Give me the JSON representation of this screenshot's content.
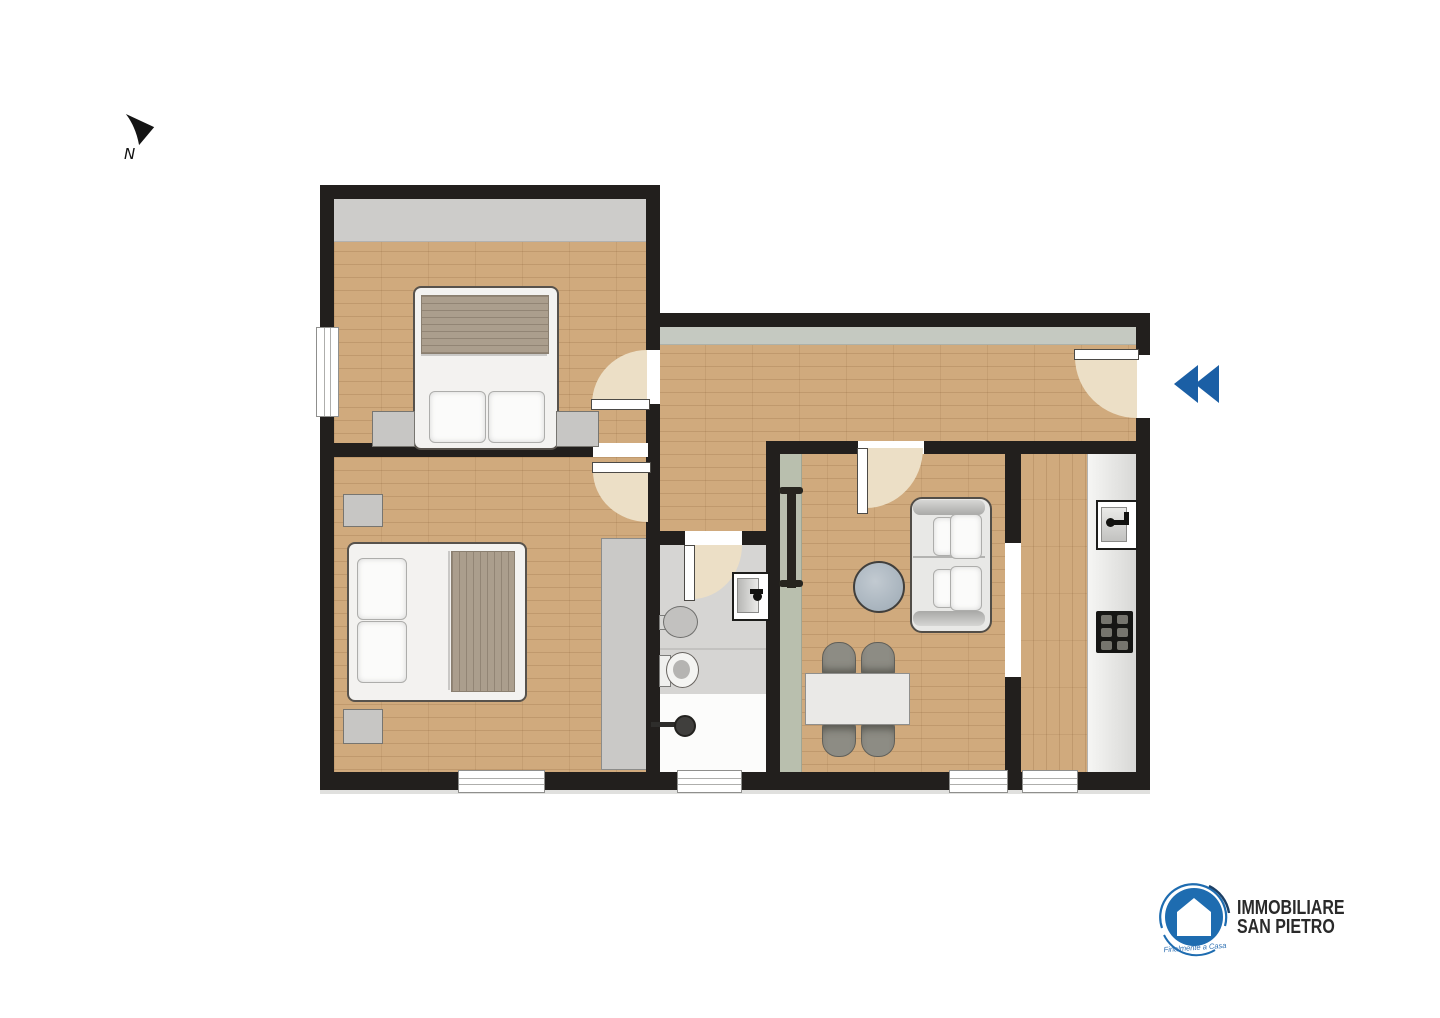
{
  "canvas": {
    "width": 1440,
    "height": 1018,
    "background": "#ffffff"
  },
  "compass": {
    "label": "N"
  },
  "entrance": {
    "color": "#1b5fa5"
  },
  "logo": {
    "line1": "IMMOBILIARE",
    "line2": "SAN PIETRO",
    "tagline": "Finalmente a Casa",
    "circle_color": "#1e6cb0",
    "swirl_dark": "#1c4066",
    "text_color": "#2a2a2a"
  },
  "palette": {
    "wall": "#221f1d",
    "wood": "#d0aa7d",
    "wood_line": "rgba(125,85,45,0.20)",
    "wood_seam": "rgba(120,80,40,0.12)",
    "tile": "#d6d5d3",
    "door_arc": "#ecdfc6",
    "blanket": "#ab9e8d",
    "band_gray": "#cdccca",
    "band_green": "#c5c9c1",
    "sage": "#b9bfae"
  },
  "plan": {
    "shapes": [
      {
        "n": "bedroom1-floor",
        "t": "wood-h",
        "x": 334,
        "y": 199,
        "w": 312,
        "h": 244
      },
      {
        "n": "bedroom1-closet-band",
        "t": "rect",
        "x": 334,
        "y": 199,
        "w": 312,
        "h": 42,
        "f": "#cdccca",
        "bb": "1px solid #b2b1af"
      },
      {
        "n": "bedroom2-floor",
        "t": "wood-h",
        "x": 334,
        "y": 457,
        "w": 312,
        "h": 319
      },
      {
        "n": "hallway-floor",
        "t": "wood-h",
        "x": 658,
        "y": 327,
        "w": 478,
        "h": 116
      },
      {
        "n": "hallway-band",
        "t": "rect",
        "x": 658,
        "y": 327,
        "w": 478,
        "h": 17,
        "f": "#c5c9c1",
        "bb": "1px solid #adb1a9"
      },
      {
        "n": "hallway-extension-floor",
        "t": "wood-h",
        "x": 658,
        "y": 441,
        "w": 108,
        "h": 92
      },
      {
        "n": "living-floor",
        "t": "wood-h",
        "x": 780,
        "y": 452,
        "w": 227,
        "h": 324
      },
      {
        "n": "living-sage-strip",
        "t": "rect",
        "x": 780,
        "y": 452,
        "w": 21,
        "h": 324,
        "f": "#b9bfae",
        "brr": "1px solid #a0a593"
      },
      {
        "n": "kitchen-floor",
        "t": "wood-v",
        "x": 1020,
        "y": 452,
        "w": 116,
        "h": 324
      },
      {
        "n": "kitchen-counter",
        "t": "rect",
        "x": 1087,
        "y": 452,
        "w": 49,
        "h": 324,
        "f": "linear-gradient(90deg,#f6f6f4,#d7d7d5)",
        "bll": "1px solid #b3b3b1"
      },
      {
        "n": "bathroom-floor",
        "t": "rect",
        "x": 660,
        "y": 545,
        "w": 106,
        "h": 231,
        "f": "#d6d5d3"
      },
      {
        "n": "bathroom-zone-divider",
        "t": "rect",
        "x": 660,
        "y": 648,
        "w": 106,
        "h": 2,
        "f": "#c3c2c0"
      },
      {
        "n": "shower-floor",
        "t": "rect",
        "x": 660,
        "y": 694,
        "w": 106,
        "h": 82,
        "f": "#fcfcfb"
      },
      {
        "n": "bedroom2-wardrobe",
        "t": "rect",
        "x": 601,
        "y": 538,
        "w": 45,
        "h": 230,
        "f": "#cac9c7",
        "bd": "1px solid #8c8c8a"
      },
      {
        "n": "wall-bedroom1-top",
        "t": "wall",
        "x": 320,
        "y": 185,
        "w": 340,
        "h": 14
      },
      {
        "n": "wall-left",
        "t": "wall",
        "x": 320,
        "y": 185,
        "w": 14,
        "h": 605
      },
      {
        "n": "wall-bottom",
        "t": "wall",
        "x": 320,
        "y": 772,
        "w": 830,
        "h": 18
      },
      {
        "n": "plan-bottom-shadow",
        "t": "rect",
        "x": 320,
        "y": 790,
        "w": 830,
        "h": 4,
        "f": "#e0e0de"
      },
      {
        "n": "wall-bedroom1-right",
        "t": "wall",
        "x": 646,
        "y": 185,
        "w": 14,
        "h": 272
      },
      {
        "n": "wall-hallway-top",
        "t": "wall",
        "x": 646,
        "y": 313,
        "w": 504,
        "h": 14
      },
      {
        "n": "wall-bedrooms-divider",
        "t": "wall",
        "x": 320,
        "y": 443,
        "w": 340,
        "h": 14
      },
      {
        "n": "wall-bathroom-left",
        "t": "wall",
        "x": 646,
        "y": 457,
        "w": 14,
        "h": 319
      },
      {
        "n": "wall-right",
        "t": "wall",
        "x": 1136,
        "y": 313,
        "w": 14,
        "h": 477
      },
      {
        "n": "wall-living-kitchen-top",
        "t": "wall",
        "x": 766,
        "y": 441,
        "w": 370,
        "h": 13
      },
      {
        "n": "wall-living-left",
        "t": "wall",
        "x": 766,
        "y": 441,
        "w": 14,
        "h": 335
      },
      {
        "n": "wall-bathroom-top",
        "t": "wall",
        "x": 646,
        "y": 531,
        "w": 120,
        "h": 14
      },
      {
        "n": "wall-living-kitchen-divider",
        "t": "wall",
        "x": 1005,
        "y": 441,
        "w": 16,
        "h": 335
      },
      {
        "n": "bedroom1-door-opening",
        "t": "open",
        "x": 646,
        "y": 350,
        "w": 14,
        "h": 54
      },
      {
        "n": "bedroom2-door-opening",
        "t": "open",
        "x": 593,
        "y": 443,
        "w": 55,
        "h": 14
      },
      {
        "n": "bathroom-door-opening",
        "t": "open",
        "x": 685,
        "y": 531,
        "w": 57,
        "h": 14
      },
      {
        "n": "living-door-opening",
        "t": "open",
        "x": 858,
        "y": 441,
        "w": 66,
        "h": 13
      },
      {
        "n": "kitchen-passage-opening",
        "t": "open",
        "x": 1005,
        "y": 543,
        "w": 16,
        "h": 134
      },
      {
        "n": "entrance-opening",
        "t": "open",
        "x": 1136,
        "y": 355,
        "w": 14,
        "h": 63
      },
      {
        "n": "bedroom1-window",
        "t": "window-v",
        "x": 316,
        "y": 327,
        "w": 21,
        "h": 88
      },
      {
        "n": "bedroom2-window",
        "t": "window-h",
        "x": 458,
        "y": 770,
        "w": 85,
        "h": 21
      },
      {
        "n": "bathroom-window",
        "t": "window-h",
        "x": 677,
        "y": 770,
        "w": 63,
        "h": 21
      },
      {
        "n": "living-window",
        "t": "window-h",
        "x": 949,
        "y": 770,
        "w": 57,
        "h": 21
      },
      {
        "n": "kitchen-window",
        "t": "window-h",
        "x": 1022,
        "y": 770,
        "w": 54,
        "h": 21
      },
      {
        "n": "bedroom1-door-arc",
        "t": "arc",
        "x": 592,
        "y": 350,
        "w": 55,
        "h": 54,
        "c": "tl"
      },
      {
        "n": "bedroom1-door-leaf",
        "t": "leaf",
        "x": 591,
        "y": 399,
        "w": 57,
        "h": 9
      },
      {
        "n": "bedroom2-door-arc",
        "t": "arc",
        "x": 593,
        "y": 471,
        "w": 55,
        "h": 51,
        "c": "bl"
      },
      {
        "n": "bedroom2-door-leaf",
        "t": "leaf",
        "x": 592,
        "y": 462,
        "w": 57,
        "h": 9
      },
      {
        "n": "bathroom-door-arc",
        "t": "arc",
        "x": 692,
        "y": 545,
        "w": 50,
        "h": 54,
        "c": "br"
      },
      {
        "n": "bathroom-door-leaf",
        "t": "leaf",
        "x": 684,
        "y": 545,
        "w": 9,
        "h": 54
      },
      {
        "n": "living-door-arc",
        "t": "arc",
        "x": 866,
        "y": 448,
        "w": 57,
        "h": 60,
        "c": "br"
      },
      {
        "n": "living-door-leaf",
        "t": "leaf",
        "x": 857,
        "y": 448,
        "w": 9,
        "h": 64
      },
      {
        "n": "entrance-door-arc",
        "t": "arc",
        "x": 1075,
        "y": 357,
        "w": 62,
        "h": 61,
        "c": "bl"
      },
      {
        "n": "entrance-door-leaf",
        "t": "leaf",
        "x": 1074,
        "y": 349,
        "w": 63,
        "h": 9
      },
      {
        "n": "bed1-frame",
        "t": "rect",
        "x": 413,
        "y": 286,
        "w": 142,
        "h": 160,
        "f": "#f3f2f0",
        "bd": "2px solid #57524c",
        "r": "8px"
      },
      {
        "n": "bed1-blanket",
        "t": "blanket-h",
        "x": 421,
        "y": 295,
        "w": 126,
        "h": 57
      },
      {
        "n": "bed1-sheet-line",
        "t": "rect",
        "x": 421,
        "y": 354,
        "w": 126,
        "h": 2,
        "f": "#c9c8c6"
      },
      {
        "n": "bed1-pillow-left",
        "t": "pillow",
        "x": 429,
        "y": 391,
        "w": 55,
        "h": 50
      },
      {
        "n": "bed1-pillow-right",
        "t": "pillow",
        "x": 488,
        "y": 391,
        "w": 55,
        "h": 50
      },
      {
        "n": "bedroom1-nightstand-left",
        "t": "rect",
        "x": 372,
        "y": 411,
        "w": 41,
        "h": 34,
        "f": "#c7c6c4",
        "bd": "1px solid #777570"
      },
      {
        "n": "bedroom1-nightstand-right",
        "t": "rect",
        "x": 556,
        "y": 411,
        "w": 41,
        "h": 34,
        "f": "#c7c6c4",
        "bd": "1px solid #777570"
      },
      {
        "n": "bed2-frame",
        "t": "rect",
        "x": 347,
        "y": 542,
        "w": 176,
        "h": 156,
        "f": "#f3f2f0",
        "bd": "2px solid #57524c",
        "r": "8px"
      },
      {
        "n": "bed2-blanket",
        "t": "blanket-v",
        "x": 451,
        "y": 551,
        "w": 62,
        "h": 139
      },
      {
        "n": "bed2-sheet-line",
        "t": "rect",
        "x": 448,
        "y": 551,
        "w": 2,
        "h": 139,
        "f": "#c9c8c6"
      },
      {
        "n": "bed2-pillow-top",
        "t": "pillow",
        "x": 357,
        "y": 558,
        "w": 48,
        "h": 60
      },
      {
        "n": "bed2-pillow-bottom",
        "t": "pillow",
        "x": 357,
        "y": 621,
        "w": 48,
        "h": 60
      },
      {
        "n": "bedroom2-nightstand-top",
        "t": "rect",
        "x": 343,
        "y": 494,
        "w": 38,
        "h": 31,
        "f": "#c7c6c4",
        "bd": "1px solid #777570"
      },
      {
        "n": "bedroom2-nightstand-bottom",
        "t": "rect",
        "x": 343,
        "y": 709,
        "w": 38,
        "h": 33,
        "f": "#c7c6c4",
        "bd": "1px solid #777570"
      },
      {
        "n": "radiator-bar",
        "t": "rect",
        "x": 787,
        "y": 489,
        "w": 9,
        "h": 99,
        "f": "#27251f"
      },
      {
        "n": "radiator-cap-top",
        "t": "rect",
        "x": 779,
        "y": 487,
        "w": 24,
        "h": 7,
        "f": "#27251f",
        "r": "3px"
      },
      {
        "n": "radiator-cap-bottom",
        "t": "rect",
        "x": 779,
        "y": 580,
        "w": 24,
        "h": 7,
        "f": "#27251f",
        "r": "3px"
      },
      {
        "n": "sofa-frame",
        "t": "rect",
        "x": 910,
        "y": 497,
        "w": 78,
        "h": 132,
        "f": "#e8e8e6",
        "bd": "2px solid #514d47",
        "r": "12px"
      },
      {
        "n": "sofa-armrest-top",
        "t": "rect",
        "x": 913,
        "y": 500,
        "w": 72,
        "h": 15,
        "f": "linear-gradient(180deg,#d6d6d4,#a9a9a7)",
        "r": "7px"
      },
      {
        "n": "sofa-armrest-bottom",
        "t": "rect",
        "x": 913,
        "y": 611,
        "w": 72,
        "h": 15,
        "f": "linear-gradient(0deg,#d6d6d4,#a9a9a7)",
        "r": "7px"
      },
      {
        "n": "sofa-seat-divider",
        "t": "rect",
        "x": 913,
        "y": 556,
        "w": 72,
        "h": 2,
        "f": "#b3b3b1"
      },
      {
        "n": "sofa-pillow-1",
        "t": "pillow",
        "x": 933,
        "y": 517,
        "w": 20,
        "h": 37
      },
      {
        "n": "sofa-pillow-2",
        "t": "pillow",
        "x": 950,
        "y": 514,
        "w": 30,
        "h": 43
      },
      {
        "n": "sofa-pillow-3",
        "t": "pillow",
        "x": 933,
        "y": 569,
        "w": 20,
        "h": 37
      },
      {
        "n": "sofa-pillow-4",
        "t": "pillow",
        "x": 950,
        "y": 566,
        "w": 30,
        "h": 43
      },
      {
        "n": "coffee-table",
        "t": "ellipse",
        "x": 853,
        "y": 561,
        "w": 48,
        "h": 48,
        "f": "radial-gradient(circle at 42% 38%,#c2cad1,#9daab5)",
        "bd": "2px solid #413f3c"
      },
      {
        "n": "dining-chair-1",
        "t": "chair-t",
        "x": 822,
        "y": 642,
        "w": 32,
        "h": 33
      },
      {
        "n": "dining-chair-2",
        "t": "chair-t",
        "x": 861,
        "y": 642,
        "w": 32,
        "h": 33
      },
      {
        "n": "dining-chair-3",
        "t": "chair-b",
        "x": 822,
        "y": 722,
        "w": 32,
        "h": 33
      },
      {
        "n": "dining-chair-4",
        "t": "chair-b",
        "x": 861,
        "y": 722,
        "w": 32,
        "h": 33
      },
      {
        "n": "dining-table",
        "t": "rect",
        "x": 805,
        "y": 673,
        "w": 103,
        "h": 50,
        "f": "#eae9e7",
        "bd": "1px solid #8f8f8d"
      },
      {
        "n": "bathroom-sink",
        "t": "rect",
        "x": 732,
        "y": 572,
        "w": 34,
        "h": 45,
        "f": "#ffffff",
        "bd": "2px solid #1d1d1b"
      },
      {
        "n": "bathroom-sink-basin",
        "t": "rect",
        "x": 737,
        "y": 578,
        "w": 20,
        "h": 33,
        "f": "linear-gradient(90deg,#b7b7b5,#ebebe9)",
        "bd": "1px solid #8b8b89"
      },
      {
        "n": "bathroom-faucet",
        "t": "rect",
        "x": 750,
        "y": 589,
        "w": 13,
        "h": 5,
        "f": "#121210"
      },
      {
        "n": "bathroom-faucet-knob",
        "t": "ellipse",
        "x": 753,
        "y": 592,
        "w": 9,
        "h": 9,
        "f": "#121210"
      },
      {
        "n": "bidet-arm",
        "t": "rect",
        "x": 659,
        "y": 615,
        "w": 9,
        "h": 13,
        "f": "#d7d7d5",
        "bd": "1px solid #7c7c7a"
      },
      {
        "n": "bidet",
        "t": "ellipse",
        "x": 663,
        "y": 606,
        "w": 33,
        "h": 30,
        "f": "#c2c1bf",
        "bd": "1px solid #6f6f6d"
      },
      {
        "n": "toilet-tank",
        "t": "rect",
        "x": 659,
        "y": 655,
        "w": 10,
        "h": 30,
        "f": "#f0f0ee",
        "bd": "1px solid #7c7c7a"
      },
      {
        "n": "toilet",
        "t": "ellipse",
        "x": 666,
        "y": 652,
        "w": 31,
        "h": 34,
        "f": "#f4f4f2",
        "bd": "1px solid #67635f"
      },
      {
        "n": "toilet-bowl-inner",
        "t": "ellipse",
        "x": 673,
        "y": 660,
        "w": 17,
        "h": 19,
        "f": "#b5b4b2"
      },
      {
        "n": "shower-arm",
        "t": "rect",
        "x": 651,
        "y": 722,
        "w": 27,
        "h": 5,
        "f": "#2e2d2b"
      },
      {
        "n": "shower-head",
        "t": "ellipse",
        "x": 674,
        "y": 715,
        "w": 18,
        "h": 18,
        "f": "#403f3d",
        "bd": "2px solid #23221f"
      },
      {
        "n": "kitchen-sink",
        "t": "rect",
        "x": 1096,
        "y": 500,
        "w": 38,
        "h": 46,
        "f": "#ffffff",
        "bd": "2px solid #1d1d1b"
      },
      {
        "n": "kitchen-sink-basin",
        "t": "rect",
        "x": 1101,
        "y": 507,
        "w": 24,
        "h": 33,
        "f": "linear-gradient(180deg,#eaeae8,#c2c2c0)",
        "bd": "1px solid #8b8b89"
      },
      {
        "n": "kitchen-faucet-knob",
        "t": "ellipse",
        "x": 1106,
        "y": 518,
        "w": 9,
        "h": 9,
        "f": "#121210"
      },
      {
        "n": "kitchen-faucet",
        "t": "rect",
        "x": 1114,
        "y": 520,
        "w": 14,
        "h": 5,
        "f": "#121210"
      },
      {
        "n": "kitchen-faucet-tip",
        "t": "rect",
        "x": 1124,
        "y": 512,
        "w": 5,
        "h": 13,
        "f": "#121210"
      },
      {
        "n": "kitchen-stove",
        "t": "stove",
        "x": 1096,
        "y": 611,
        "w": 37,
        "h": 42
      }
    ]
  }
}
